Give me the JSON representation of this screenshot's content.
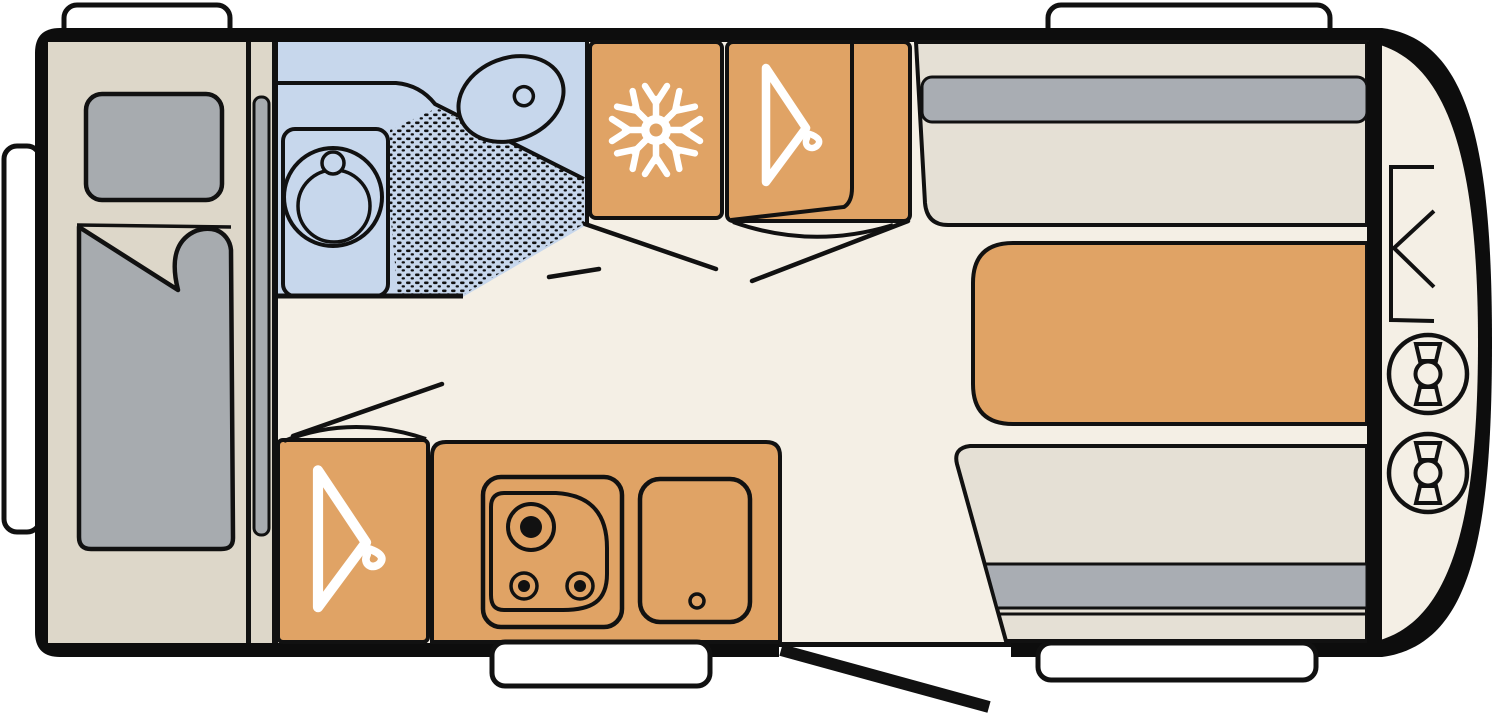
{
  "meta": {
    "diagram_type": "caravan-floor-plan-top-view",
    "canvas": {
      "width": 1500,
      "height": 713
    }
  },
  "colors": {
    "outside": "#ffffff",
    "wall": "#0d0d0d",
    "floor": "#f4efe5",
    "furniture_orange": "#e0a365",
    "bathroom_blue": "#c7d7ec",
    "upholstery_gray": "#a7abaf",
    "backrest_gray": "#a9adb3",
    "bed_base": "#ddd7c9",
    "bench_beige": "#e5e0d5",
    "window_white": "#ffffff",
    "line_black": "#111111",
    "icon_white": "#ffffff",
    "dot_black": "#111111"
  },
  "areas": {
    "bed_area": {
      "name": "fixed-bed",
      "items": [
        "pillow",
        "duvet"
      ],
      "partition": "sliding-door"
    },
    "bathroom": {
      "name": "washroom",
      "items": [
        "worktop",
        "washbasin",
        "faucet",
        "toilet",
        "shower-tray"
      ]
    },
    "fridge": {
      "name": "refrigerator",
      "icon": "snowflake-icon"
    },
    "wardrobe_top": {
      "name": "wardrobe",
      "icon": "hanger-icon",
      "door": "open"
    },
    "wardrobe_bottom": {
      "name": "wardrobe",
      "icon": "hanger-icon",
      "door": "open"
    },
    "kitchen": {
      "name": "kitchen-block",
      "items": [
        "hob-3-burner",
        "sink-with-drain"
      ]
    },
    "dinette": {
      "name": "front-dinette",
      "items": [
        "bench-seat-top",
        "table",
        "bench-seat-bottom"
      ]
    },
    "gas_locker": {
      "name": "front-gas-locker",
      "items": [
        "locker-hatch",
        "gas-bottle",
        "gas-bottle"
      ]
    }
  },
  "openings": {
    "windows": 4,
    "entry_door": {
      "state": "open",
      "side": "bottom"
    },
    "entry_step": 1
  }
}
